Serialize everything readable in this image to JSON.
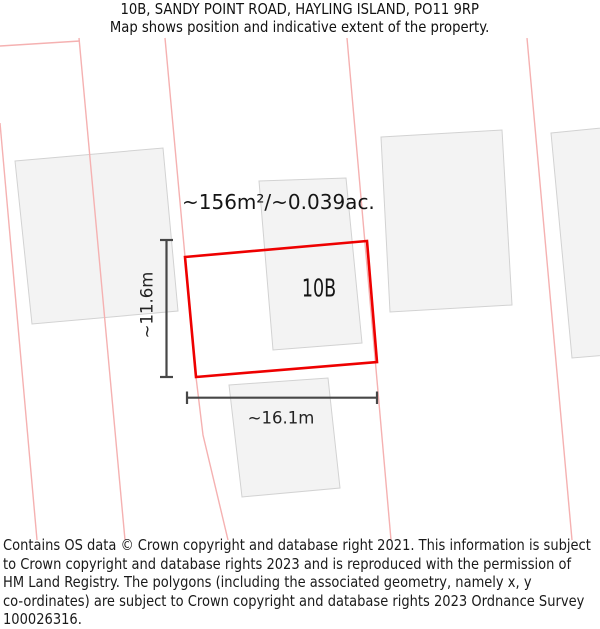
{
  "header": {
    "title": "10B, SANDY POINT ROAD, HAYLING ISLAND, PO11 9RP",
    "subtitle": "Map shows position and indicative extent of the property."
  },
  "map": {
    "property_label": "10B",
    "area_label": "~156m²/~0.039ac.",
    "dim_width_label": "~16.1m",
    "dim_height_label": "~11.6m",
    "colors": {
      "background": "#ffffff",
      "boundary_red": "#ee0000",
      "parcel_pink": "#f5b1b1",
      "building_fill": "#f3f3f3",
      "building_stroke": "#d2d2d2",
      "dimension_gray": "#474747"
    },
    "geometry": {
      "red_polygon": "185,257 367,241 377,362 196,377",
      "buildings": [
        "15,161 163,148 178,311 32,324",
        "259,181 346,178 362,343 273,350",
        "381,137 502,130 512,305 390,312",
        "551,133 612,127 620,354 572,358",
        "229,385 328,378 340,488 242,497"
      ],
      "parcel_lines": [
        "0,123 37,540",
        "0,46 80,41",
        "79,38 125,540",
        "165,38 196,377 203,435 228,540",
        "347,38 391,540",
        "527,38 572,540"
      ],
      "dimension_segments": [
        {
          "x1": 166.5,
          "y1": 240,
          "x2": 166.5,
          "y2": 377
        },
        {
          "x1": 160,
          "y1": 240,
          "x2": 173,
          "y2": 240
        },
        {
          "x1": 160,
          "y1": 377,
          "x2": 173,
          "y2": 377
        },
        {
          "x1": 187,
          "y1": 397.7,
          "x2": 377,
          "y2": 397.7
        },
        {
          "x1": 187,
          "y1": 391.5,
          "x2": 187,
          "y2": 404
        },
        {
          "x1": 377,
          "y1": 391.5,
          "x2": 377,
          "y2": 404
        }
      ]
    }
  },
  "footer": {
    "lines": [
      "Contains OS data © Crown copyright and database right 2021. This information is subject",
      "to Crown copyright and database rights 2023 and is reproduced with the permission of",
      "HM Land Registry. The polygons (including the associated geometry, namely x, y",
      "co-ordinates) are subject to Crown copyright and database rights 2023 Ordnance Survey",
      "100026316."
    ]
  }
}
